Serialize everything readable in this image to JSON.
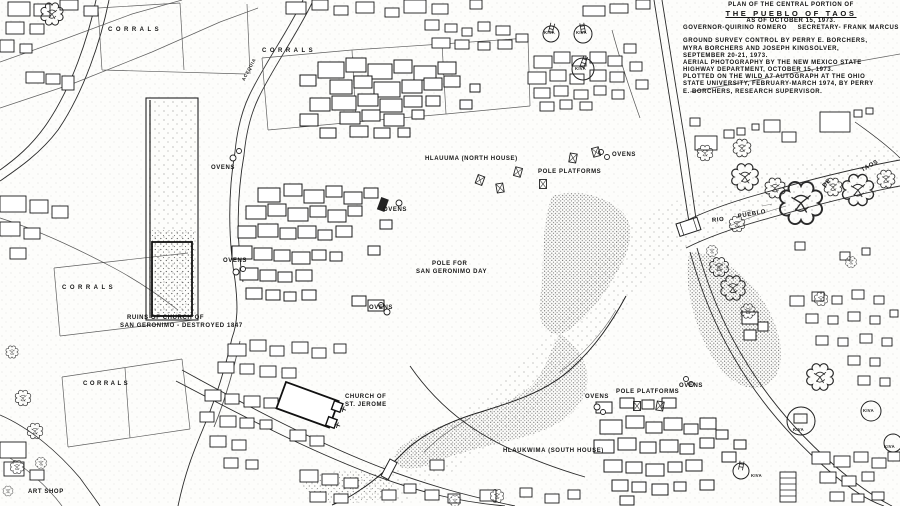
{
  "title_block": {
    "lines": [
      "PLAN  OF  THE  CENTRAL  PORTION  OF",
      "THE  PUEBLO  OF  TAOS",
      "AS  OF  OCTOBER 15, 1973.",
      "GOVERNOR-QUIRINO ROMERO",
      "SECRETARY- FRANK MARCUS",
      "GROUND SURVEY CONTROL BY PERRY E. BORCHERS,",
      "MYRA BORCHERS AND JOSEPH KINGSOLVER,",
      "SEPTEMBER 20-21, 1973.",
      "AERIAL PHOTOGRAPHY BY THE NEW MEXICO STATE",
      "HIGHWAY DEPARTMENT, OCTOBER 15, 1973.",
      "PLOTTED ON THE WILD A7 AUTOGRAPH AT THE OHIO",
      "STATE UNIVERSITY, FEBRUARY-MARCH 1974, BY PERRY",
      "E. BORCHERS, RESEARCH SUPERVISOR."
    ]
  },
  "labels": {
    "corrals": "CORRALS",
    "acequia": "ACEQUIA",
    "ovens": "OVENS",
    "kiva": "KIVA",
    "hlauuma": "HLAUUMA (NORTH  HOUSE)",
    "hlaukwima": "HLAUKWIMA (SOUTH  HOUSE)",
    "pole_platforms": "POLE  PLATFORMS",
    "pole_for_line1": "POLE  FOR",
    "pole_for_line2": "SAN  GERONIMO  DAY",
    "ruins_line1": "RUINS  OF  CHURCH  OF",
    "ruins_line2": "SAN  GERONIMO - DESTROYED 1847",
    "church_line1": "CHURCH  OF",
    "church_line2": "ST.  JEROME",
    "art_shop": "ART  SHOP",
    "rio": "RIO",
    "pueblo": "PUEBLO",
    "de": "DE",
    "taos": "TAOS"
  },
  "colors": {
    "ink": "#1b1b1b",
    "paper": "#fdfdfb"
  }
}
